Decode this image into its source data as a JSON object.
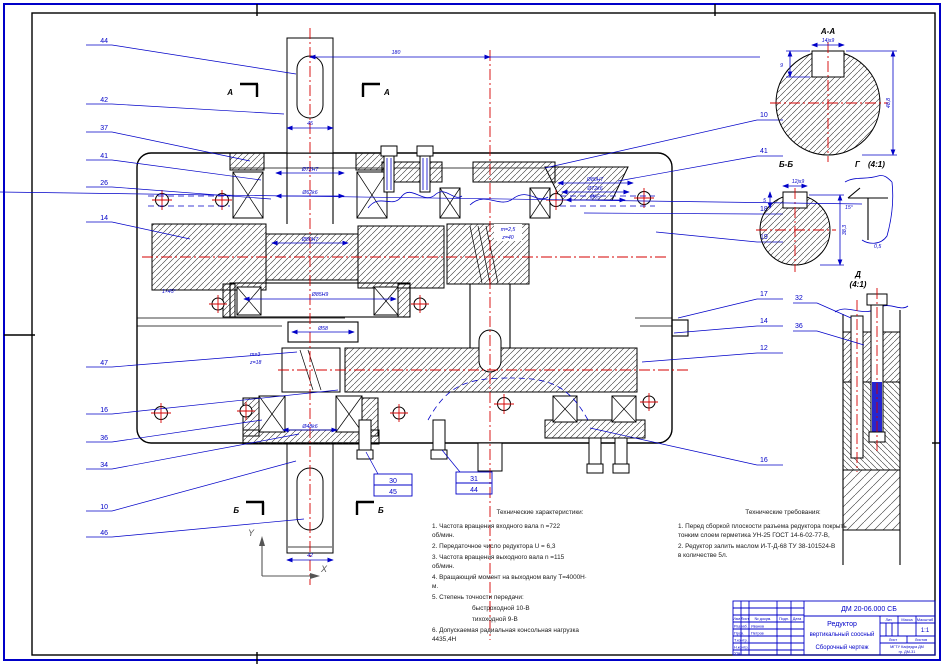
{
  "sections": {
    "a": "А",
    "b": "Б",
    "aa": "А-А",
    "bb": "Б-Б",
    "g": "Г",
    "gs": "(4:1)",
    "d": "Д",
    "ds": "(4:1)"
  },
  "axes": {
    "x": "X",
    "y": "Y"
  },
  "callouts_left": [
    "44",
    "42",
    "37",
    "41",
    "26",
    "14",
    "47",
    "16",
    "36",
    "34",
    "10",
    "46"
  ],
  "callouts_right": [
    "10",
    "41",
    "18",
    "19",
    "17",
    "14",
    "12",
    "16"
  ],
  "callouts_detail": [
    "32",
    "36"
  ],
  "boxed": [
    [
      "30",
      "45"
    ],
    [
      "31",
      "44"
    ]
  ],
  "dims": {
    "aw": "180",
    "top_stub": "45",
    "bot_stub": "42",
    "s1": "Ø72H7",
    "s2": "Ø62k6",
    "s3": "Ø80H7",
    "s4": "Ø85H9",
    "s5": "Ø58",
    "s6": "Ø48k6",
    "c1": "Ø80H7",
    "c2": "Ø72k6",
    "c3": "Ø65",
    "aa_top": "14js9",
    "aa_right": "48,8",
    "aa_left": "9",
    "bb_top": "12js9",
    "bb_right": "38,3",
    "bb_left": "5",
    "g_angle": "15°",
    "g_r": "0,5"
  },
  "notes": {
    "chamfer": "1×45°",
    "g1": "m=2,5",
    "g2": "z=40",
    "p1": "m=3",
    "p2": "z=18"
  },
  "tech_char": {
    "title": "Технические характеристики:",
    "lines": [
      "1. Частота вращения входного вала n =722",
      "об/мин.",
      "2. Передаточное число редуктора U = 6,3",
      "3. Частота вращения выходного вала n =115",
      "об/мин.",
      "4. Вращающий момент на выходном валу Т=4000Н·",
      "м.",
      "5. Степень точности передачи:",
      "быстроходной 10-В",
      "тихоходной 9-В",
      "6. Допускаемая радиальная консольная нагрузка",
      "4435,4Н"
    ]
  },
  "tech_req": {
    "title": "Технические требования:",
    "lines": [
      "1. Перед сборкой плоскости разъема редуктора покрыть",
      "тонким слоем герметика УН-25 ГОСТ 14-6-02-77-В,",
      "2. Редуктор залить маслом И-Т-Д-68 ТУ 38-101524-В",
      "в количестве 5л."
    ]
  },
  "titleblock": {
    "doc": "ДМ 20-06.000 СБ",
    "name1": "Редуктор",
    "name2": "вертикальный соосный",
    "name3": "Сборочный чертеж",
    "h_izm": "Изм.",
    "h_list": "Лист",
    "h_ndoc": "№ докум.",
    "h_podp": "Подп.",
    "h_data": "Дата",
    "r1": "Разраб.",
    "r2": "Пров.",
    "r3": "Т.контр.",
    "r4": "Н.контр.",
    "r5": "Утв.",
    "n1": "Иванов",
    "n2": "Петров",
    "lit": "Лит.",
    "massa": "Масса",
    "masshtab": "Масштаб",
    "scale": "1:1",
    "sheet": "Лист",
    "sheets": "Листов",
    "org1": "МГТУ  Кафедра ДМ",
    "org2": "гр. ДМ-31"
  }
}
